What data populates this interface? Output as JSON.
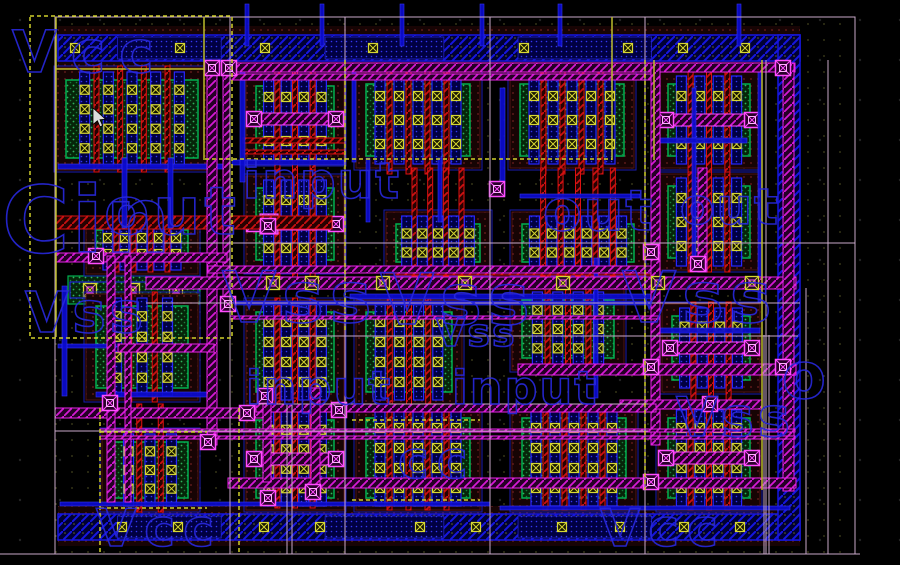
{
  "canvas": {
    "width": 900,
    "height": 565
  },
  "colors": {
    "background": "#000000",
    "grid_dot": "#232323",
    "region_dot": "#43431d",
    "metal1_blue": "#1616e0",
    "metal1_fill": "#0b0bd0",
    "metal2_magenta": "#e822e8",
    "via_magenta": "#ff4cff",
    "poly_red": "#dd1111",
    "diff_green": "#00b050",
    "contact_yellow": "#d6d633",
    "implant_maroon": "#521414",
    "frame_lavender": "#c9a9c9",
    "boundary_yellow": "#bcbc2a",
    "label_blue": "#2828dd",
    "cursor_white": "#dcdcdc"
  },
  "background_labels": [
    {
      "text": "Vcc",
      "x": 12,
      "y": 72,
      "size": 58,
      "ls": 14
    },
    {
      "text": "Cin",
      "x": 2,
      "y": 252,
      "size": 92,
      "ls": 2
    },
    {
      "text": "out",
      "x": 104,
      "y": 234,
      "size": 66,
      "ls": 4
    },
    {
      "text": "input",
      "x": 243,
      "y": 198,
      "size": 50,
      "ls": 2
    },
    {
      "text": "out",
      "x": 543,
      "y": 230,
      "size": 56,
      "ls": 2
    },
    {
      "text": "out",
      "x": 680,
      "y": 224,
      "size": 50,
      "ls": 2
    },
    {
      "text": "Vss",
      "x": 222,
      "y": 322,
      "size": 70,
      "ls": 6
    },
    {
      "text": "Vss",
      "x": 380,
      "y": 324,
      "size": 70,
      "ls": 6
    },
    {
      "text": "Vss",
      "x": 622,
      "y": 322,
      "size": 70,
      "ls": 6
    },
    {
      "text": "Vss",
      "x": 25,
      "y": 332,
      "size": 56,
      "ls": 4
    },
    {
      "text": "Vss",
      "x": 436,
      "y": 346,
      "size": 38,
      "ls": 2
    },
    {
      "text": "input",
      "x": 246,
      "y": 404,
      "size": 46,
      "ls": 2
    },
    {
      "text": "input",
      "x": 452,
      "y": 404,
      "size": 46,
      "ls": 2
    },
    {
      "text": "Vss",
      "x": 676,
      "y": 436,
      "size": 54,
      "ls": 4
    },
    {
      "text": "o",
      "x": 782,
      "y": 398,
      "size": 64,
      "ls": 0
    },
    {
      "text": "Vcc",
      "x": 96,
      "y": 546,
      "size": 52,
      "ls": 8
    },
    {
      "text": "cc",
      "x": 398,
      "y": 478,
      "size": 52,
      "ls": 8
    },
    {
      "text": "Vcc",
      "x": 600,
      "y": 546,
      "size": 52,
      "ls": 8
    }
  ],
  "rails": {
    "top": {
      "x": 58,
      "y": 35,
      "w": 742,
      "h": 26,
      "contacts": [
        75,
        180,
        265,
        373,
        524,
        628,
        683,
        745
      ]
    },
    "bottom": {
      "x": 58,
      "y": 514,
      "w": 742,
      "h": 26,
      "contacts": [
        122,
        178,
        264,
        320,
        420,
        476,
        562,
        620,
        684,
        740
      ]
    },
    "right": {
      "x": 778,
      "y": 35,
      "w": 22,
      "h": 505
    }
  },
  "green_channel": {
    "x": 68,
    "y": 276,
    "w": 132,
    "h": 28,
    "vias": [
      90,
      133,
      176
    ]
  },
  "cells": [
    {
      "x": 66,
      "y": 80,
      "w": 132,
      "h": 78,
      "nf": 5
    },
    {
      "x": 256,
      "y": 86,
      "w": 78,
      "h": 66,
      "nf": 4,
      "strap": true,
      "pb": 18
    },
    {
      "x": 366,
      "y": 84,
      "w": 104,
      "h": 72,
      "nf": 5,
      "pb": 18
    },
    {
      "x": 520,
      "y": 84,
      "w": 104,
      "h": 72,
      "nf": 5,
      "pb": 18
    },
    {
      "x": 668,
      "y": 84,
      "w": 82,
      "h": 72,
      "nf": 4,
      "strap": true,
      "pb": 18
    },
    {
      "x": 256,
      "y": 188,
      "w": 78,
      "h": 72,
      "nf": 4,
      "strap": true,
      "bright": true,
      "pt": 18,
      "pb": 18
    },
    {
      "x": 396,
      "y": 224,
      "w": 84,
      "h": 38,
      "nf": 5,
      "pt": 56
    },
    {
      "x": 522,
      "y": 224,
      "w": 112,
      "h": 38,
      "nf": 6,
      "pt": 56
    },
    {
      "x": 668,
      "y": 186,
      "w": 82,
      "h": 72,
      "nf": 4
    },
    {
      "x": 96,
      "y": 230,
      "w": 92,
      "h": 32,
      "nf": 5,
      "pt": 10,
      "pb": 10
    },
    {
      "x": 96,
      "y": 306,
      "w": 92,
      "h": 82,
      "nf": 3
    },
    {
      "x": 256,
      "y": 312,
      "w": 78,
      "h": 80,
      "nf": 4,
      "pb": 16
    },
    {
      "x": 366,
      "y": 312,
      "w": 86,
      "h": 80,
      "nf": 4,
      "pb": 16
    },
    {
      "x": 522,
      "y": 300,
      "w": 92,
      "h": 58,
      "nf": 4,
      "pt": 34
    },
    {
      "x": 672,
      "y": 316,
      "w": 78,
      "h": 64,
      "nf": 4,
      "strap": true,
      "pb": 28
    },
    {
      "x": 112,
      "y": 442,
      "w": 76,
      "h": 56,
      "nf": 3,
      "pt": 38
    },
    {
      "x": 256,
      "y": 420,
      "w": 78,
      "h": 78,
      "nf": 4,
      "strap": true,
      "pt": 22,
      "pb": 10
    },
    {
      "x": 366,
      "y": 418,
      "w": 104,
      "h": 80,
      "nf": 5,
      "pb": 12
    },
    {
      "x": 522,
      "y": 418,
      "w": 104,
      "h": 80,
      "nf": 5,
      "pb": 12
    },
    {
      "x": 668,
      "y": 418,
      "w": 82,
      "h": 80,
      "nf": 4,
      "strap": true,
      "pb": 12
    }
  ],
  "m2_routes": [
    [
      "h",
      228,
      63,
      567,
      9
    ],
    [
      "h",
      228,
      74,
      432,
      6
    ],
    [
      "v",
      207,
      63,
      382,
      10
    ],
    [
      "v",
      223,
      63,
      243,
      7
    ],
    [
      "h",
      146,
      277,
      650,
      12
    ],
    [
      "h",
      55,
      253,
      172,
      9
    ],
    [
      "h",
      208,
      266,
      452,
      7
    ],
    [
      "v",
      651,
      63,
      382,
      9
    ],
    [
      "v",
      698,
      168,
      104,
      9
    ],
    [
      "v",
      783,
      63,
      428,
      11
    ],
    [
      "h",
      518,
      364,
      278,
      11
    ],
    [
      "h",
      620,
      400,
      142,
      9
    ],
    [
      "h",
      55,
      408,
      212,
      10
    ],
    [
      "h",
      256,
      404,
      400,
      8
    ],
    [
      "h",
      228,
      478,
      568,
      10
    ],
    [
      "v",
      311,
      388,
      108,
      9
    ],
    [
      "v",
      263,
      396,
      86,
      8
    ],
    [
      "v",
      107,
      256,
      246,
      8
    ],
    [
      "v",
      125,
      256,
      246,
      6
    ],
    [
      "h",
      118,
      344,
      96,
      8
    ],
    [
      "h",
      100,
      429,
      695,
      3
    ],
    [
      "h",
      100,
      436,
      695,
      3
    ],
    [
      "h",
      230,
      316,
      430,
      3
    ]
  ],
  "poly_routes": [
    [
      "h",
      56,
      216,
      276,
      13
    ],
    [
      "h",
      394,
      266,
      266,
      9
    ],
    [
      "h",
      243,
      138,
      102,
      5
    ],
    [
      "h",
      243,
      150,
      102,
      4
    ]
  ],
  "m1_routes": [
    [
      "v",
      245,
      4,
      42,
      4
    ],
    [
      "v",
      320,
      4,
      42,
      4
    ],
    [
      "v",
      400,
      4,
      42,
      4
    ],
    [
      "v",
      480,
      4,
      42,
      4
    ],
    [
      "v",
      558,
      4,
      42,
      4
    ],
    [
      "v",
      737,
      4,
      42,
      4
    ],
    [
      "h",
      58,
      164,
      172,
      5
    ],
    [
      "h",
      232,
      160,
      112,
      5
    ],
    [
      "h",
      350,
      294,
      308,
      5
    ],
    [
      "h",
      230,
      301,
      430,
      4
    ],
    [
      "h",
      96,
      392,
      116,
      5
    ],
    [
      "h",
      660,
      328,
      100,
      5
    ],
    [
      "h",
      520,
      194,
      120,
      4
    ],
    [
      "h",
      60,
      502,
      430,
      4
    ],
    [
      "v",
      240,
      64,
      118,
      5
    ],
    [
      "v",
      352,
      64,
      98,
      4
    ],
    [
      "v",
      500,
      88,
      108,
      5
    ],
    [
      "v",
      692,
      88,
      180,
      4
    ],
    [
      "v",
      758,
      64,
      238,
      4
    ],
    [
      "v",
      366,
      158,
      64,
      4
    ],
    [
      "v",
      438,
      158,
      64,
      4
    ],
    [
      "v",
      594,
      258,
      140,
      4
    ],
    [
      "v",
      122,
      158,
      70,
      5
    ],
    [
      "v",
      168,
      158,
      70,
      5
    ],
    [
      "h",
      655,
      138,
      92,
      5
    ],
    [
      "h",
      58,
      344,
      58,
      4
    ],
    [
      "v",
      62,
      286,
      110,
      5
    ],
    [
      "h",
      500,
      506,
      290,
      4
    ]
  ],
  "vias": [
    [
      212,
      68
    ],
    [
      229,
      68
    ],
    [
      268,
      226
    ],
    [
      497,
      189
    ],
    [
      651,
      252
    ],
    [
      698,
      264
    ],
    [
      783,
      68
    ],
    [
      783,
      367
    ],
    [
      710,
      404
    ],
    [
      313,
      492
    ],
    [
      265,
      396
    ],
    [
      339,
      410
    ],
    [
      651,
      482
    ],
    [
      208,
      442
    ],
    [
      651,
      367
    ],
    [
      228,
      304
    ],
    [
      96,
      256
    ],
    [
      110,
      403
    ],
    [
      247,
      413
    ],
    [
      268,
      498
    ]
  ],
  "channel_vias": {
    "y": 283,
    "xs": [
      273,
      312,
      383,
      465,
      563,
      658,
      752
    ]
  },
  "frames": {
    "outer": [
      55,
      17,
      800,
      537
    ],
    "lines": [
      [
        230,
        17,
        230,
        554
      ],
      [
        345,
        17,
        345,
        554
      ],
      [
        490,
        17,
        490,
        554
      ],
      [
        645,
        17,
        645,
        554
      ],
      [
        766,
        60,
        766,
        554
      ],
      [
        806,
        288,
        806,
        554
      ],
      [
        828,
        60,
        828,
        554
      ],
      [
        287,
        404,
        287,
        554
      ],
      [
        292,
        404,
        292,
        554
      ],
      [
        764,
        335,
        764,
        554
      ],
      [
        769,
        335,
        769,
        554
      ],
      [
        55,
        243,
        855,
        243
      ],
      [
        146,
        303,
        800,
        303
      ],
      [
        290,
        336,
        798,
        336
      ],
      [
        250,
        404,
        648,
        404
      ],
      [
        55,
        431,
        648,
        431
      ],
      [
        0,
        554,
        860,
        554
      ]
    ]
  },
  "yellow_solid": [
    [
      56,
      17,
      56,
      337
    ],
    [
      56,
      69,
      204,
      69
    ],
    [
      204,
      17,
      204,
      160
    ],
    [
      612,
      17,
      612,
      160
    ],
    [
      762,
      60,
      762,
      490
    ],
    [
      654,
      60,
      654,
      160
    ]
  ],
  "yellow_dashed": {
    "rect": [
      30,
      16,
      202,
      322
    ],
    "lines": [
      [
        100,
        408,
        100,
        553
      ],
      [
        239,
        408,
        239,
        553
      ],
      [
        345,
        60,
        345,
        332
      ],
      [
        645,
        60,
        645,
        490
      ],
      [
        205,
        159,
        612,
        159
      ],
      [
        100,
        432,
        207,
        432
      ],
      [
        100,
        508,
        207,
        508
      ],
      [
        352,
        420,
        480,
        420
      ],
      [
        352,
        500,
        480,
        500
      ]
    ]
  },
  "cursor": {
    "x": 93,
    "y": 108
  }
}
